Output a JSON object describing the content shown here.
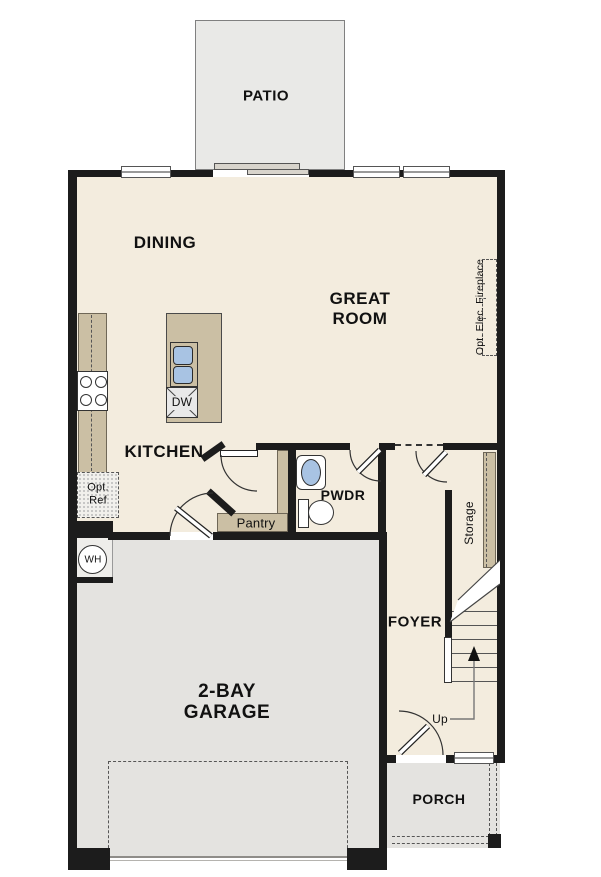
{
  "labels": {
    "patio": "PATIO",
    "dining": "DINING",
    "great_room_line1": "GREAT",
    "great_room_line2": "ROOM",
    "kitchen": "KITCHEN",
    "dishwasher": "DW",
    "opt_ref_line1": "Opt.",
    "opt_ref_line2": "Ref",
    "water_heater": "WH",
    "pantry": "Pantry",
    "powder_room": "PWDR",
    "storage": "Storage",
    "fireplace": "Opt. Elec. Fireplace",
    "foyer": "FOYER",
    "stairs_up": "Up",
    "garage_line1": "2-BAY",
    "garage_line2": "GARAGE",
    "porch": "PORCH"
  },
  "colors": {
    "wall": "#1c1c1c",
    "floor": "#f3ecde",
    "garage": "#e4e3e0",
    "patio": "#e9e9e7",
    "casework": "#cbbfa4",
    "fixture_blue": "#a8c3e3"
  }
}
